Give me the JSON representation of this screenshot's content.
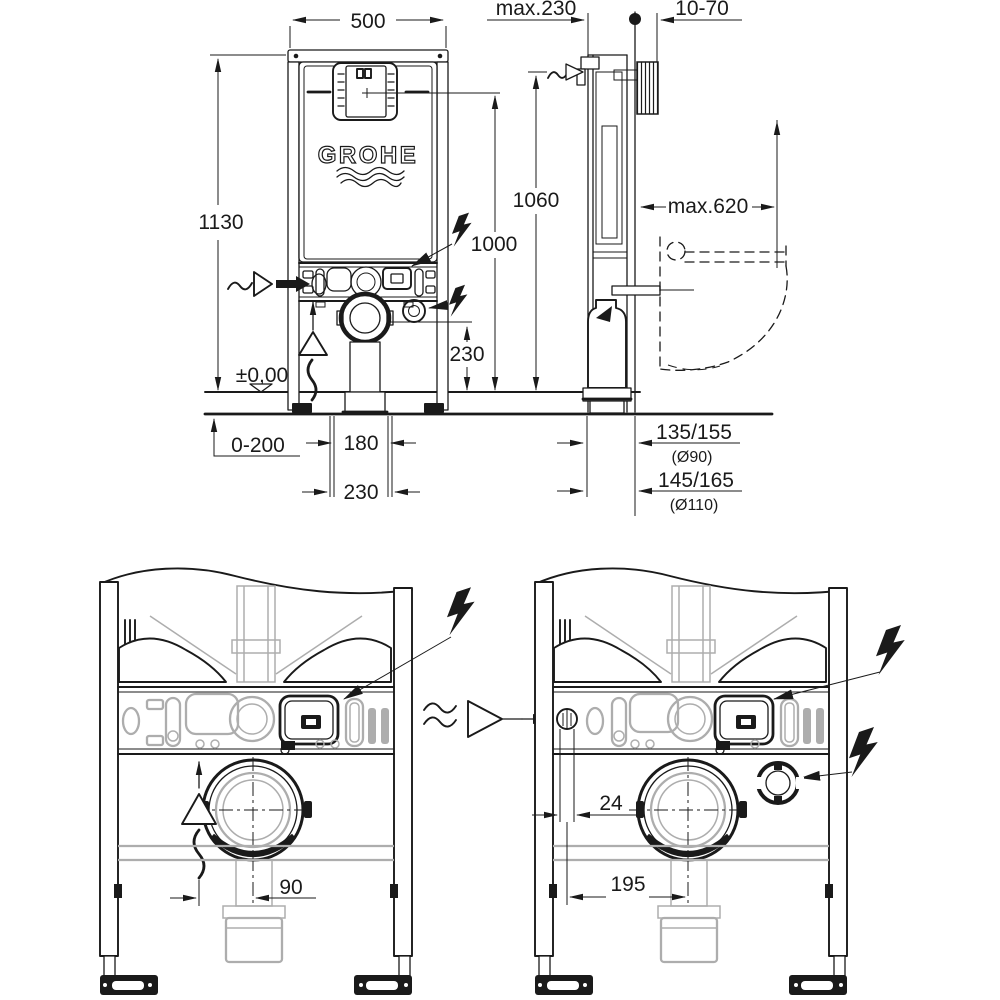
{
  "page": {
    "background": "#ffffff"
  },
  "colors": {
    "ink": "#1a1a1a",
    "ghost": "#adadad",
    "background": "#ffffff"
  },
  "brand": "GROHE",
  "drawing_type": "wc-installation-frame-dimensional-drawing",
  "labels": {
    "front_view": {
      "width": "500",
      "height": "1130",
      "actuation_height": "1000",
      "outlet_height": "230",
      "floor_level": "±0,00",
      "floor_buildup": "0-200",
      "outlet_offset": "180",
      "supply_offset": "230"
    },
    "side_view": {
      "frame_depth": "max.230",
      "wall_thickness": "10-70",
      "plate_height": "1060",
      "toilet_depth": "max.620",
      "outlet_90": "135/155",
      "outlet_90_dia": "(Ø90)",
      "outlet_110": "145/165",
      "outlet_110_dia": "(Ø110)"
    },
    "detail_left": {
      "extraction_offset": "90"
    },
    "detail_right": {
      "hole_offset": "24",
      "supply_offset": "195"
    }
  }
}
